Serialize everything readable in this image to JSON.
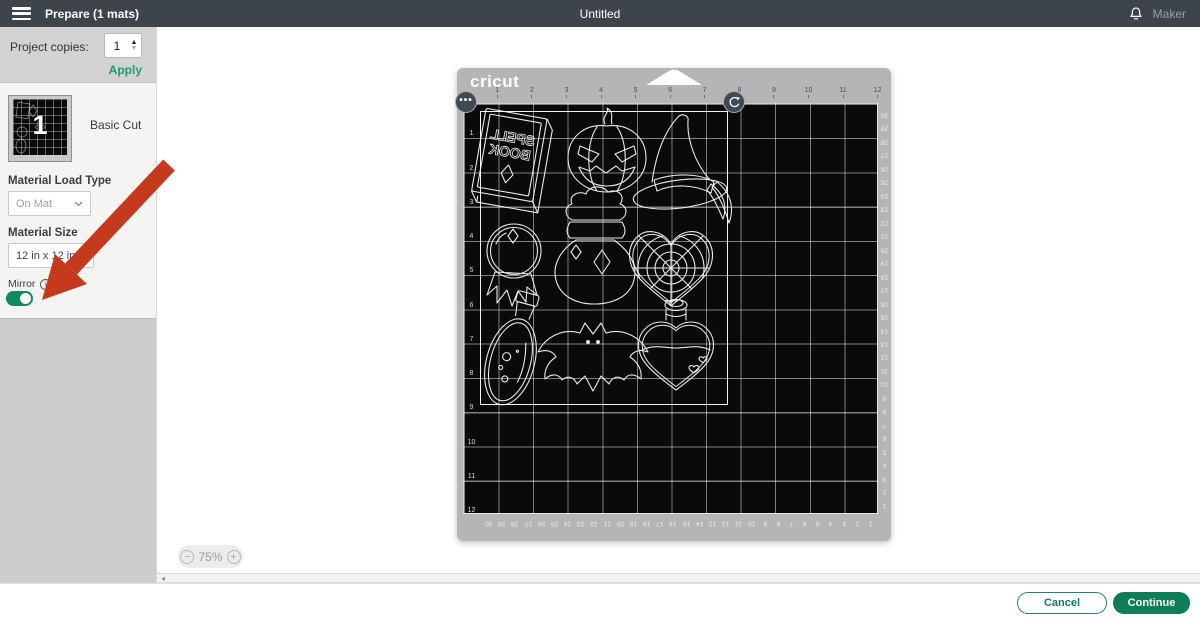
{
  "topbar": {
    "title": "Prepare (1 mats)",
    "document_title": "Untitled",
    "machine_name": "Maker"
  },
  "sidebar": {
    "project_copies": {
      "label": "Project copies:",
      "value": "1",
      "apply_label": "Apply"
    },
    "mat_card": {
      "mat_number": "1",
      "cut_type": "Basic Cut"
    },
    "material_load_type": {
      "label": "Material Load Type",
      "value": "On Mat"
    },
    "material_size": {
      "label": "Material Size",
      "value": "12 in x 12 in"
    },
    "mirror": {
      "label": "Mirror",
      "enabled": true
    }
  },
  "canvas": {
    "zoom": {
      "value": "75%",
      "minus": "−",
      "plus": "+"
    },
    "mat": {
      "brand": "cricut",
      "top_ruler": [
        "1",
        "2",
        "3",
        "4",
        "5",
        "6",
        "7",
        "8",
        "9",
        "10",
        "11",
        "12"
      ],
      "left_ruler": [
        "1",
        "2",
        "3",
        "4",
        "5",
        "6",
        "7",
        "8",
        "9",
        "10",
        "11",
        "12"
      ],
      "right_ruler": [
        "30",
        "29",
        "28",
        "27",
        "26",
        "25",
        "24",
        "23",
        "22",
        "21",
        "20",
        "19",
        "18",
        "17",
        "16",
        "15",
        "14",
        "13",
        "12",
        "11",
        "10",
        "9",
        "8",
        "7",
        "6",
        "5",
        "4",
        "3",
        "2",
        "1"
      ],
      "bottom_ruler": [
        "30",
        "29",
        "28",
        "27",
        "26",
        "25",
        "24",
        "23",
        "22",
        "21",
        "20",
        "19",
        "18",
        "17",
        "16",
        "15",
        "14",
        "13",
        "12",
        "11",
        "10",
        "9",
        "8",
        "7",
        "6",
        "5",
        "4",
        "3",
        "2",
        "1"
      ],
      "spell_book_line1": "SPELL",
      "spell_book_line2": "BOOK",
      "designs": [
        "spell-book",
        "jack-o-lantern",
        "witch-hat",
        "crystal-ball",
        "potion-sack",
        "heart-spiderweb",
        "potion-bottle",
        "bat",
        "heart-potion-bottle"
      ]
    }
  },
  "footer": {
    "cancel_label": "Cancel",
    "continue_label": "Continue"
  },
  "annotation": {
    "arrow_color": "#C53A1D"
  },
  "colors": {
    "accent_green": "#107c58",
    "topbar_bg": "#3e444b",
    "mat_frame": "#b5b5b5"
  }
}
